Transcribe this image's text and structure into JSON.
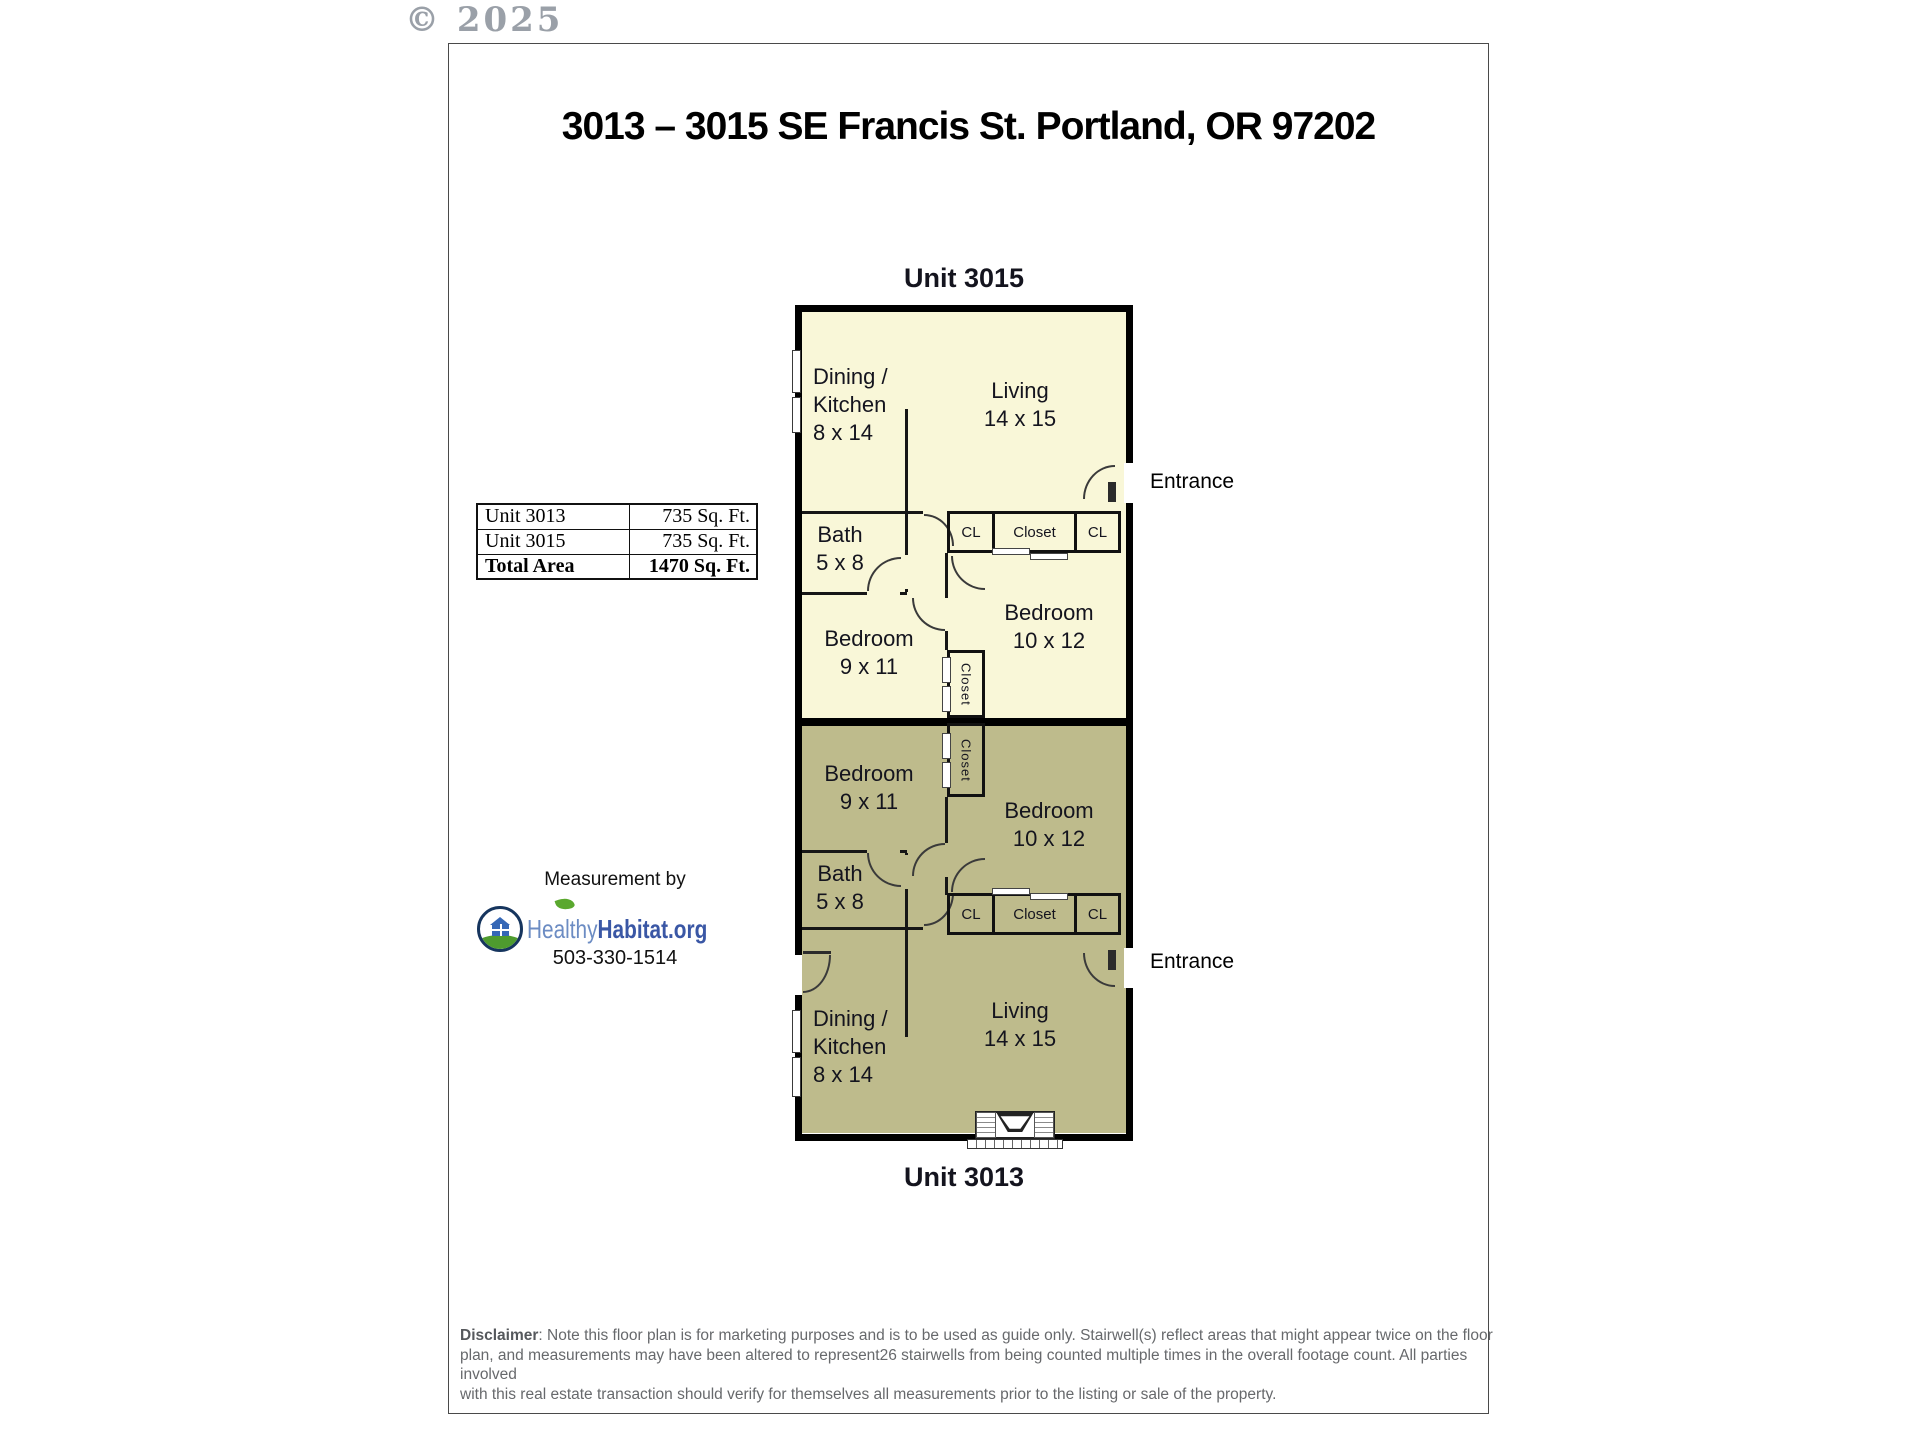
{
  "page": {
    "copyright": "© 2025",
    "title": "3013 – 3015 SE Francis St. Portland, OR 97202"
  },
  "floorplan": {
    "unit_top_label": "Unit 3015",
    "unit_bottom_label": "Unit 3013",
    "rooms": {
      "dining": "Dining /\nKitchen\n8 x 14",
      "living": "Living\n14 x 15",
      "bath": "Bath\n5 x 8",
      "bedroom_small": "Bedroom\n9 x 11",
      "bedroom_large": "Bedroom\n10 x 12",
      "closet": "Closet",
      "cl": "CL",
      "entrance": "Entrance"
    },
    "colors": {
      "unit_3015_fill": "#f9f7d8",
      "unit_3013_fill": "#bebb8c",
      "wall": "#000000"
    }
  },
  "area_table": {
    "rows": [
      {
        "label": "Unit 3013",
        "value": "735 Sq. Ft."
      },
      {
        "label": "Unit 3015",
        "value": "735 Sq. Ft."
      },
      {
        "label": "Total Area",
        "value": "1470 Sq. Ft."
      }
    ]
  },
  "credit": {
    "heading": "Measurement by",
    "logo_healthy": "Healthy",
    "logo_habitat": "Habitat.org",
    "phone": "503-330-1514",
    "logo_colors": {
      "healthy": "#6c8cc3",
      "habitat": "#3a57a5",
      "grass": "#4e9b2e",
      "navy": "#16355e"
    }
  },
  "disclaimer": {
    "label": "Disclaimer",
    "line1": ": Note this floor plan is for marketing purposes and is to be used as guide only.  Stairwell(s) reflect areas that might appear twice on the floor",
    "line2": "plan, and measurements may have been altered to represent26 stairwells from being counted multiple times in the overall footage count.  All parties involved",
    "line3": "with this real estate transaction should verify for themselves all measurements prior to the listing or sale of the property."
  }
}
